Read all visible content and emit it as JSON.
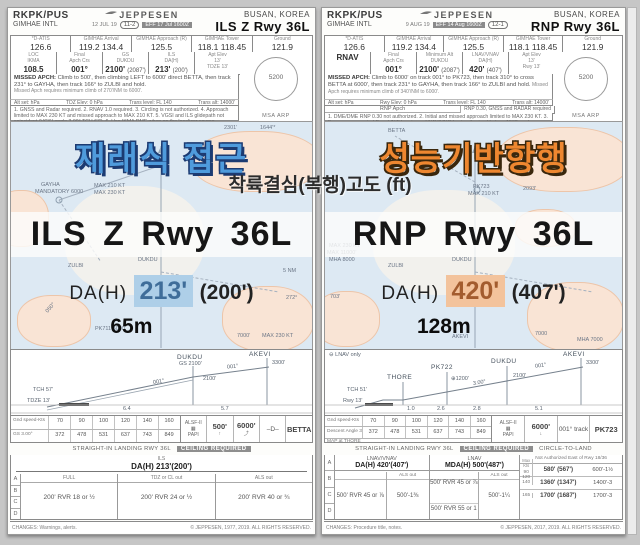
{
  "page": {
    "bg": "#c6c6c6",
    "center_caption": "착륙결심(복행)고도 (ft)"
  },
  "left": {
    "accent": "#4f9bdc",
    "header": {
      "icao": "RKPK/PUS",
      "airport": "GIMHAE INTL",
      "brand": "JEPPESEN",
      "date": "12 JUL 19",
      "index": "11-2",
      "eff": "EFF 17 Jul 1600Z",
      "city": "BUSAN, KOREA",
      "title": "ILS Z Rwy 36L"
    },
    "freqs": [
      {
        "label": "*D-ATIS",
        "value": "126.6"
      },
      {
        "label": "GIMHAE Arrival",
        "value": "119.2  134.4"
      },
      {
        "label": "GIMHAE Approach (R)",
        "value": "125.5"
      },
      {
        "label": "GIMHAE Tower",
        "value": "118.1  118.45"
      },
      {
        "label": "Ground",
        "value": "121.9"
      }
    ],
    "brief": [
      {
        "label": "LOC",
        "label2": "IKMA",
        "value": "108.5",
        "value2": ""
      },
      {
        "label": "Final",
        "label2": "Apch Crs",
        "value": "001°",
        "value2": ""
      },
      {
        "label": "GS",
        "label2": "DUKDU",
        "value": "2100'",
        "value2": "(2087')"
      },
      {
        "label": "ILS",
        "label2": "DA(H)",
        "value": "213'",
        "value2": "(200')"
      },
      {
        "label": "Apt Elev",
        "label2": "13'",
        "value": "TDZE 13'",
        "value2": ""
      }
    ],
    "missed": {
      "title": "MISSED APCH:",
      "text": "Climb to 500', then climbing LEFT to 6000' direct BETTA, then track 231° to GAYHA, then track 166° to ZULBI and hold.",
      "note": "Missed Apch requires minimum climb of 270'/NM to 6000'."
    },
    "altset": [
      "Alt set: hPa",
      "TDZ Elev: 0 hPa",
      "Trans level: FL 140",
      "Trans alt: 14000'"
    ],
    "notes": "1. GNSS and Radar required. 2. RNAV 1.0 required. 3. Circling is not authorized. 4. Approach limited to MAX 230 KT and missed approach to MAX 210 KT. 5. VGSI and ILS glidepath not coincident (VGSI angle 3.00° TCH 67'). 6. Use IKMA DME when on the localizer course.",
    "msa": {
      "value": "5200",
      "label": "MSA ARP"
    },
    "overlay": {
      "korean": "재래식 접근",
      "title": "ILS Z Rwy 36L",
      "da_label": "DA(H)",
      "da_value": "213'",
      "da_paren": "(200')",
      "meters": "65m",
      "highlight_bg": "#aecfe8",
      "highlight_fg": "#3f6d99"
    },
    "map_labels": [
      "2301'",
      "1644'*",
      "GAYHA",
      "MANDATORY 6000",
      "MAX 210 KT",
      "MAX 230 KT",
      "ZULBI",
      "DUKDU",
      "5 NM",
      "272°",
      "PK711 5000",
      "MAX 230 KT",
      "7000'",
      "050°"
    ],
    "profile": {
      "fix1": "DUKDU",
      "fix1_sub": "GS 2100'",
      "fix1_alt": "2100'",
      "fix2": "AKEVI",
      "fix2_alt": "3300'",
      "crs1": "001°",
      "crs2": "001°",
      "tch": "TCH 57'",
      "tdze": "TDZE 13'",
      "d1": "6.4",
      "d2": "5.7",
      "gs_label": "Gnd speed-Kts",
      "speeds": [
        "70",
        "90",
        "100",
        "120",
        "140",
        "160"
      ],
      "rate_label": "GS",
      "angle": "3.00°",
      "rates": [
        "372",
        "478",
        "531",
        "637",
        "743",
        "849"
      ],
      "papi_sys": "ALSF-II",
      "papi": "PAPI",
      "cell1": "500'",
      "cell1_icon": "↑",
      "cell2": "6000'",
      "cell2_icon": "⤴",
      "hold_sym": "–D–",
      "hold": "BETTA",
      "strip": "STRAIGHT-IN LANDING RWY 36L",
      "ceiling": "CEILING REQUIRED"
    },
    "mins": {
      "approach": "ILS",
      "da": "DA(H) 213'(200')",
      "cols": [
        "FULL",
        "TDZ or CL out",
        "ALS out"
      ],
      "rows": [
        "A",
        "B",
        "C",
        "D"
      ],
      "values": [
        "200'  RVR 18 or ½",
        "200'  RVR 24 or ½",
        "200'  RVR 40 or ¾"
      ]
    },
    "footer": {
      "changes": "CHANGES: Warnings, alerts.",
      "copyright": "© JEPPESEN, 1977, 2019. ALL RIGHTS RESERVED."
    }
  },
  "right": {
    "accent": "#ee8730",
    "header": {
      "icao": "RKPK/PUS",
      "airport": "GIMHAE INTL",
      "brand": "JEPPESEN",
      "date": "9 AUG 19",
      "index": "12-1",
      "eff": "EFF 14 Aug 1600Z",
      "city": "BUSAN, KOREA",
      "title": "RNP Rwy 36L"
    },
    "freqs": [
      {
        "label": "*D-ATIS",
        "value": "126.6"
      },
      {
        "label": "GIMHAE Arrival",
        "value": "119.2  134.4"
      },
      {
        "label": "GIMHAE Approach (R)",
        "value": "125.5"
      },
      {
        "label": "GIMHAE Tower",
        "value": "118.1  118.45"
      },
      {
        "label": "Ground",
        "value": "121.9"
      }
    ],
    "brief": [
      {
        "label": "",
        "label2": "",
        "value": "RNAV",
        "value2": ""
      },
      {
        "label": "Final",
        "label2": "Apch Crs",
        "value": "001°",
        "value2": ""
      },
      {
        "label": "Minimum Alt",
        "label2": "DUKDU",
        "value": "2100'",
        "value2": "(2087')"
      },
      {
        "label": "LNAV/VNAV",
        "label2": "DA(H)",
        "value": "420'",
        "value2": "(407')"
      },
      {
        "label": "Apt Elev",
        "label2": "13'",
        "value": "Rwy 13'",
        "value2": ""
      }
    ],
    "missed": {
      "title": "MISSED APCH:",
      "text": "Climb to 6000' on track 001° to PK723, then track 310° to cross BETTA at 6000', then track 231° to GAYHA, then track 166° to ZULBI and hold.",
      "note": "Missed Apch requires minimum climb of 340'/NM to 6000'."
    },
    "altset": [
      "Alt set: hPa",
      "Rwy Elev: 0 hPa",
      "Trans level: FL 140",
      "Trans alt: 14000'"
    ],
    "rnp": {
      "label": "RNP Apch",
      "value": "RNP 0.30, GNSS and RADAR required"
    },
    "notes": "1. DME/DME RNP 0.30 not authorized. 2. Initial and missed approach limited to MAX 230 KT. 3. For uncompensated Baro-VNAV systems, LNAV/VNAV not authorized below -15°C or above 54°C. 4. VGSI and RNAV glidepath not coincident.",
    "msa": {
      "value": "5200",
      "label": "MSA ARP"
    },
    "overlay": {
      "korean": "성능기반항행",
      "title": "RNP Rwy 36L",
      "da_label": "DA(H)",
      "da_value": "420'",
      "da_paren": "(407')",
      "meters": "128m",
      "highlight_bg": "#f3c39c",
      "highlight_fg": "#a35c2e"
    },
    "map_labels": [
      "BETTA",
      "PK723",
      "MAX 210 KT",
      "2093'",
      "ZULBI",
      "DUKDU",
      "MAX 230 KT",
      "MAX 11000'",
      "MHA 8000",
      "703'",
      "AKEVI",
      "7000",
      "MHA 7000"
    ],
    "profile": {
      "lnav_note": "⊖ LNAV only",
      "fix0": "THORE",
      "fix1": "PK722",
      "fix1_alt": "⊕1200'",
      "fix2": "DUKDU",
      "fix2_alt": "2100'",
      "fix3": "AKEVI",
      "fix3_alt": "3300'",
      "crs1": "001°",
      "angle_note": "3.00°",
      "tch": "TCH 51'",
      "tdze": "Rwy 13'",
      "d0": "1.0",
      "d1": "2.6",
      "d2": "2.8",
      "d3": "5.1",
      "gs_label": "Gnd speed-Kts",
      "speeds": [
        "70",
        "90",
        "100",
        "120",
        "140",
        "160"
      ],
      "rate_label": "Descent Angle",
      "angle": "3.00°",
      "rates": [
        "372",
        "478",
        "531",
        "637",
        "743",
        "849"
      ],
      "map_note": "MAP at THORE",
      "papi_sys": "ALSF-II",
      "papi": "PAPI",
      "cell1": "6000'",
      "cell1_icon": "↓",
      "cell2": "001° track",
      "hold": "PK723",
      "strip": "STRAIGHT-IN LANDING RWY 36L",
      "ceiling": "CEILING REQUIRED",
      "circle": "CIRCLE-TO-LAND"
    },
    "mins": {
      "rows": [
        "A",
        "B",
        "C",
        "D"
      ],
      "col1": {
        "title": "LNAV/VNAV",
        "da": "DA(H) 420'(407')",
        "sub": "ALS out",
        "value": "500'  RVR 45 or ⅞",
        "als": "500'-1⅜"
      },
      "col2": {
        "title": "LNAV",
        "da": "MDA(H) 500'(487')",
        "sub": "ALS out",
        "value_ab": "500'  RVR 45 or ⅞",
        "value_cd": "500'  RVR 55 or 1",
        "als": "500'-1¼"
      },
      "col3": {
        "title": "Not Authorized East of Rwy 18/36",
        "kts_label": "Max Kts",
        "rows": [
          {
            "kts": "90 120",
            "mda": "580' (567')",
            "vis": "600'-1½"
          },
          {
            "kts": "140",
            "mda": "1360' (1347')",
            "vis": "1400'-3"
          },
          {
            "kts": "165",
            "mda": "1700' (1687')",
            "vis": "1700'-3"
          }
        ]
      }
    },
    "footer": {
      "changes": "CHANGES: Procedure title, notes.",
      "copyright": "© JEPPESEN, 2017, 2019. ALL RIGHTS RESERVED."
    }
  }
}
